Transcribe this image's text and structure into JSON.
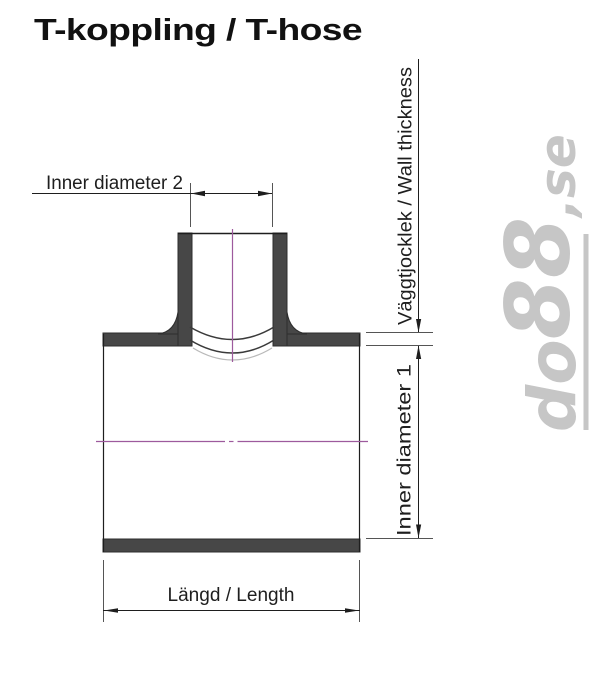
{
  "page": {
    "title": "T-koppling / T-hose"
  },
  "dimensions": {
    "inner_diameter_2": {
      "label": "Inner diameter 2"
    },
    "wall_thickness": {
      "label": "Väggtjocklek / Wall thickness"
    },
    "inner_diameter_1": {
      "label": "Inner diameter 1"
    },
    "length": {
      "label": "Längd / Length"
    }
  },
  "watermark": {
    "prefix": "do",
    "number": "88",
    "suffix": ",se",
    "full_text": "do88.se"
  },
  "colors": {
    "wall_fill": "#474747",
    "outline": "#1e1e1e",
    "extension_line": "#555555",
    "centerline_magenta": "#9d5a9d",
    "inner_arc_light": "#b9b9b9",
    "watermark_gray": "#c6c6c6",
    "background": "#ffffff"
  }
}
